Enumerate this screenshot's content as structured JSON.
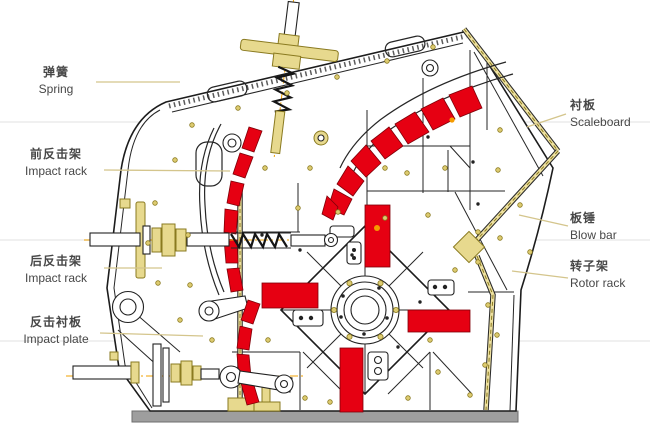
{
  "title": "Impact crusher structure diagram",
  "labels": {
    "left": [
      {
        "id": "spring",
        "zh": "弹簧",
        "en": "Spring"
      },
      {
        "id": "front-impact-rack",
        "zh": "前反击架",
        "en": "Impact rack"
      },
      {
        "id": "rear-impact-rack",
        "zh": "后反击架",
        "en": "Impact rack"
      },
      {
        "id": "impact-plate",
        "zh": "反击衬板",
        "en": "Impact plate"
      }
    ],
    "right": [
      {
        "id": "scaleboard",
        "zh": "衬板",
        "en": "Scaleboard"
      },
      {
        "id": "blow-bar",
        "zh": "板锤",
        "en": "Blow bar"
      },
      {
        "id": "rotor-rack",
        "zh": "转子架",
        "en": "Rotor rack"
      }
    ]
  },
  "colors": {
    "part_red": "#e60012",
    "part_red_dark": "#7f0008",
    "brass": "#e7d98e",
    "brass_dark": "#8a7a20",
    "line": "#1c1c1c",
    "base_gray": "#9e9e9e",
    "leader": "#d4c58c",
    "centerline": "#f0a000",
    "text": "#474747",
    "bg": "#ffffff",
    "orange_dot": "#f59b00"
  }
}
